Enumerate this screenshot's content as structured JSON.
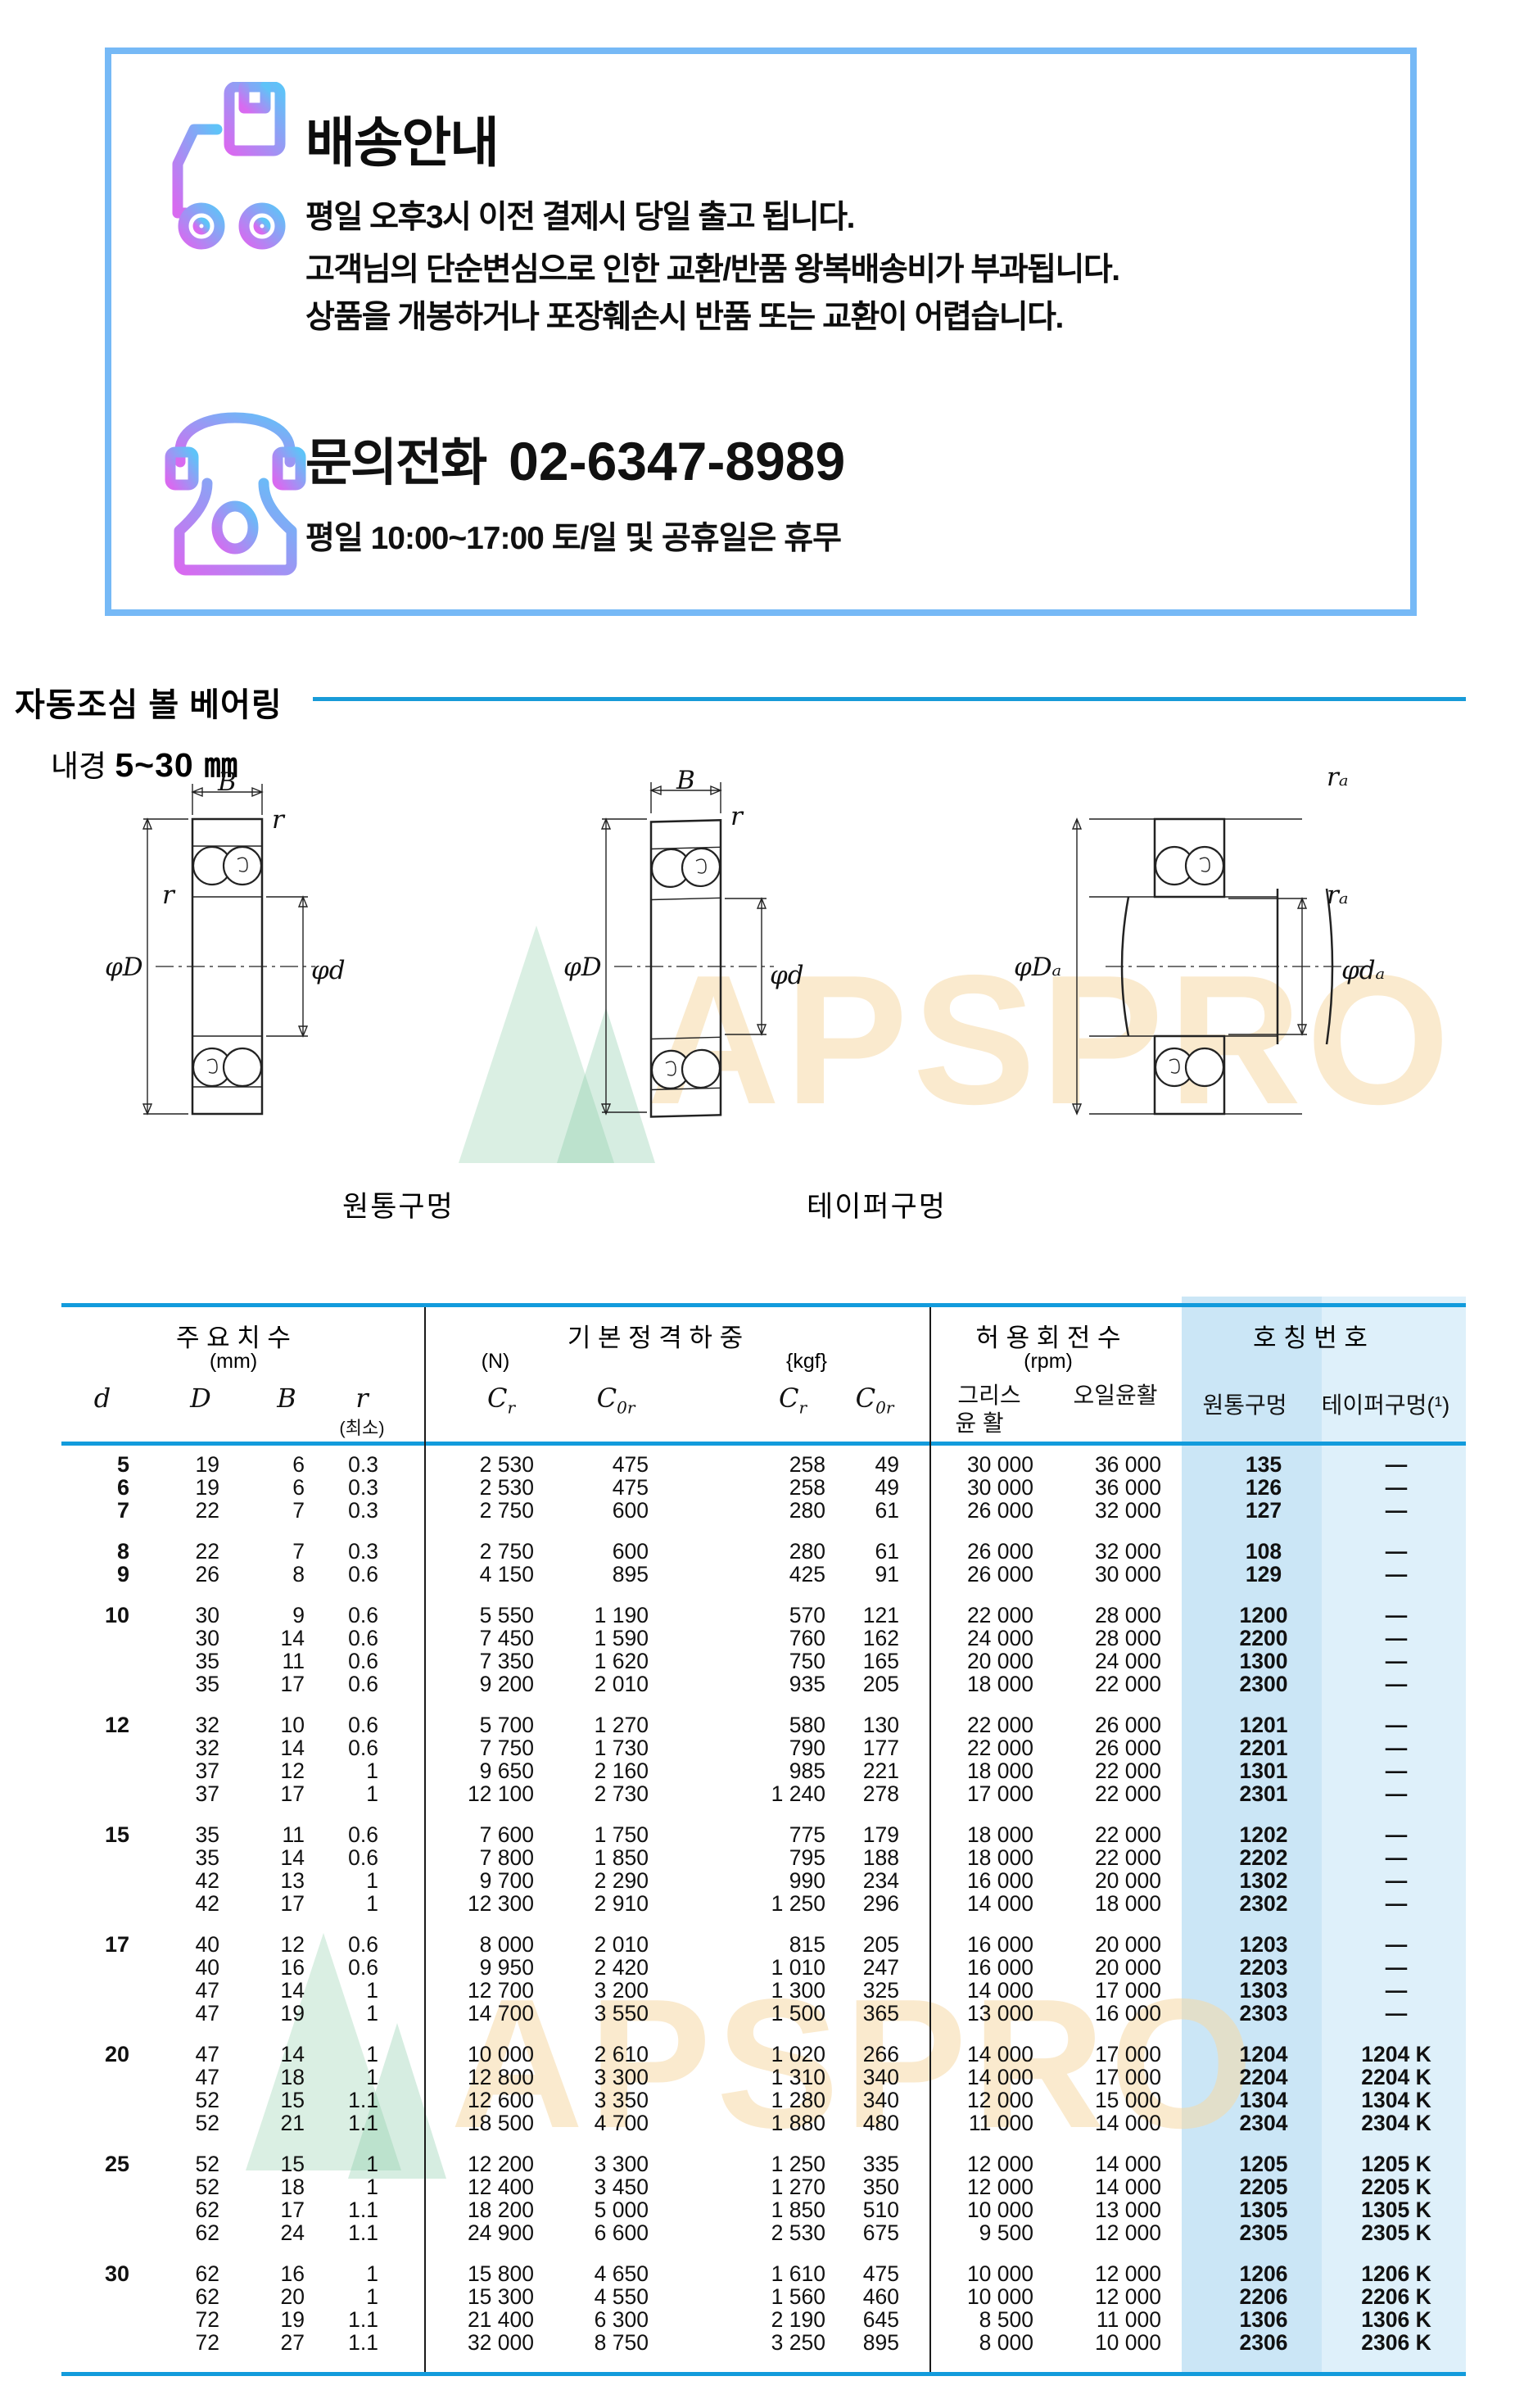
{
  "banner": {
    "title": "배송안내",
    "lines": [
      "평일 오후3시 이전 결제시 당일 출고 됩니다.",
      "고객님의 단순변심으로 인한 교환/반품 왕복배송비가 부과됩니다.",
      "상품을 개봉하거나 포장훼손시 반품 또는 교환이 어렵습니다."
    ],
    "phone_label": "문의전화",
    "phone_number": "02-6347-8989",
    "phone_hours": "평일 10:00~17:00 토/일 및 공휴일은 휴무",
    "accent_border": "#76b9f6",
    "icon_gradient_from": "#c678f2",
    "icon_gradient_to": "#5fc3f8"
  },
  "section": {
    "title": "자동조심 볼 베어링",
    "subtitle_label": "내경",
    "subtitle_value": "5~30 ㎜",
    "rule_color": "#189bd8"
  },
  "watermark": {
    "text": "APSPRO"
  },
  "diagrams": {
    "captions": {
      "cylindrical": "원통구멍",
      "tapered": "테이퍼구멍"
    },
    "dims": {
      "B": "B",
      "r": "r",
      "ra": "rₐ",
      "phiD": "φD",
      "phid": "φd",
      "phiDa": "φDₐ",
      "phida": "φdₐ"
    }
  },
  "table": {
    "header": {
      "g1": "주 요 치 수",
      "g1_unit": "(mm)",
      "g2": "기 본 정 격 하 중",
      "g2_unit_n": "(N)",
      "g2_unit_kgf": "{kgf}",
      "g3": "허 용 회 전 수",
      "g3_unit": "(rpm)",
      "g4": "호 칭 번 호",
      "sub": {
        "d": "d",
        "D": "D",
        "B": "B",
        "r": "r",
        "rmin": "(최소)",
        "C": "C",
        "sub_r": "r",
        "sub_0r": "0r",
        "grease1": "그리스",
        "grease2": "윤  활",
        "oil": "오일윤활",
        "cyl": "원통구멍",
        "taper": "테이퍼구멍(¹)"
      }
    },
    "line_color": "#129bdc",
    "cyl_col_bg": "#cbe6f6",
    "taper_col_bg": "#def0fa",
    "groups": [
      {
        "rows": [
          [
            "5",
            "19",
            "6",
            "0.3",
            "2 530",
            "475",
            "258",
            "49",
            "30 000",
            "36 000",
            "135",
            "—"
          ],
          [
            "6",
            "19",
            "6",
            "0.3",
            "2 530",
            "475",
            "258",
            "49",
            "30 000",
            "36 000",
            "126",
            "—"
          ],
          [
            "7",
            "22",
            "7",
            "0.3",
            "2 750",
            "600",
            "280",
            "61",
            "26 000",
            "32 000",
            "127",
            "—"
          ]
        ]
      },
      {
        "rows": [
          [
            "8",
            "22",
            "7",
            "0.3",
            "2 750",
            "600",
            "280",
            "61",
            "26 000",
            "32 000",
            "108",
            "—"
          ],
          [
            "9",
            "26",
            "8",
            "0.6",
            "4 150",
            "895",
            "425",
            "91",
            "26 000",
            "30 000",
            "129",
            "—"
          ]
        ]
      },
      {
        "rows": [
          [
            "10",
            "30",
            "9",
            "0.6",
            "5 550",
            "1 190",
            "570",
            "121",
            "22 000",
            "28 000",
            "1200",
            "—"
          ],
          [
            "",
            "30",
            "14",
            "0.6",
            "7 450",
            "1 590",
            "760",
            "162",
            "24 000",
            "28 000",
            "2200",
            "—"
          ],
          [
            "",
            "35",
            "11",
            "0.6",
            "7 350",
            "1 620",
            "750",
            "165",
            "20 000",
            "24 000",
            "1300",
            "—"
          ],
          [
            "",
            "35",
            "17",
            "0.6",
            "9 200",
            "2 010",
            "935",
            "205",
            "18 000",
            "22 000",
            "2300",
            "—"
          ]
        ]
      },
      {
        "rows": [
          [
            "12",
            "32",
            "10",
            "0.6",
            "5 700",
            "1 270",
            "580",
            "130",
            "22 000",
            "26 000",
            "1201",
            "—"
          ],
          [
            "",
            "32",
            "14",
            "0.6",
            "7 750",
            "1 730",
            "790",
            "177",
            "22 000",
            "26 000",
            "2201",
            "—"
          ],
          [
            "",
            "37",
            "12",
            "1",
            "9 650",
            "2 160",
            "985",
            "221",
            "18 000",
            "22 000",
            "1301",
            "—"
          ],
          [
            "",
            "37",
            "17",
            "1",
            "12 100",
            "2 730",
            "1 240",
            "278",
            "17 000",
            "22 000",
            "2301",
            "—"
          ]
        ]
      },
      {
        "rows": [
          [
            "15",
            "35",
            "11",
            "0.6",
            "7 600",
            "1 750",
            "775",
            "179",
            "18 000",
            "22 000",
            "1202",
            "—"
          ],
          [
            "",
            "35",
            "14",
            "0.6",
            "7 800",
            "1 850",
            "795",
            "188",
            "18 000",
            "22 000",
            "2202",
            "—"
          ],
          [
            "",
            "42",
            "13",
            "1",
            "9 700",
            "2 290",
            "990",
            "234",
            "16 000",
            "20 000",
            "1302",
            "—"
          ],
          [
            "",
            "42",
            "17",
            "1",
            "12 300",
            "2 910",
            "1 250",
            "296",
            "14 000",
            "18 000",
            "2302",
            "—"
          ]
        ]
      },
      {
        "rows": [
          [
            "17",
            "40",
            "12",
            "0.6",
            "8 000",
            "2 010",
            "815",
            "205",
            "16 000",
            "20 000",
            "1203",
            "—"
          ],
          [
            "",
            "40",
            "16",
            "0.6",
            "9 950",
            "2 420",
            "1 010",
            "247",
            "16 000",
            "20 000",
            "2203",
            "—"
          ],
          [
            "",
            "47",
            "14",
            "1",
            "12 700",
            "3 200",
            "1 300",
            "325",
            "14 000",
            "17 000",
            "1303",
            "—"
          ],
          [
            "",
            "47",
            "19",
            "1",
            "14 700",
            "3 550",
            "1 500",
            "365",
            "13 000",
            "16 000",
            "2303",
            "—"
          ]
        ]
      },
      {
        "rows": [
          [
            "20",
            "47",
            "14",
            "1",
            "10 000",
            "2 610",
            "1 020",
            "266",
            "14 000",
            "17 000",
            "1204",
            "1204 K"
          ],
          [
            "",
            "47",
            "18",
            "1",
            "12 800",
            "3 300",
            "1 310",
            "340",
            "14 000",
            "17 000",
            "2204",
            "2204 K"
          ],
          [
            "",
            "52",
            "15",
            "1.1",
            "12 600",
            "3 350",
            "1 280",
            "340",
            "12 000",
            "15 000",
            "1304",
            "1304 K"
          ],
          [
            "",
            "52",
            "21",
            "1.1",
            "18 500",
            "4 700",
            "1 880",
            "480",
            "11 000",
            "14 000",
            "2304",
            "2304 K"
          ]
        ]
      },
      {
        "rows": [
          [
            "25",
            "52",
            "15",
            "1",
            "12 200",
            "3 300",
            "1 250",
            "335",
            "12 000",
            "14 000",
            "1205",
            "1205 K"
          ],
          [
            "",
            "52",
            "18",
            "1",
            "12 400",
            "3 450",
            "1 270",
            "350",
            "12 000",
            "14 000",
            "2205",
            "2205 K"
          ],
          [
            "",
            "62",
            "17",
            "1.1",
            "18 200",
            "5 000",
            "1 850",
            "510",
            "10 000",
            "13 000",
            "1305",
            "1305 K"
          ],
          [
            "",
            "62",
            "24",
            "1.1",
            "24 900",
            "6 600",
            "2 530",
            "675",
            "9 500",
            "12 000",
            "2305",
            "2305 K"
          ]
        ]
      },
      {
        "rows": [
          [
            "30",
            "62",
            "16",
            "1",
            "15 800",
            "4 650",
            "1 610",
            "475",
            "10 000",
            "12 000",
            "1206",
            "1206 K"
          ],
          [
            "",
            "62",
            "20",
            "1",
            "15 300",
            "4 550",
            "1 560",
            "460",
            "10 000",
            "12 000",
            "2206",
            "2206 K"
          ],
          [
            "",
            "72",
            "19",
            "1.1",
            "21 400",
            "6 300",
            "2 190",
            "645",
            "8 500",
            "11 000",
            "1306",
            "1306 K"
          ],
          [
            "",
            "72",
            "27",
            "1.1",
            "32 000",
            "8 750",
            "3 250",
            "895",
            "8 000",
            "10 000",
            "2306",
            "2306 K"
          ]
        ]
      }
    ]
  }
}
